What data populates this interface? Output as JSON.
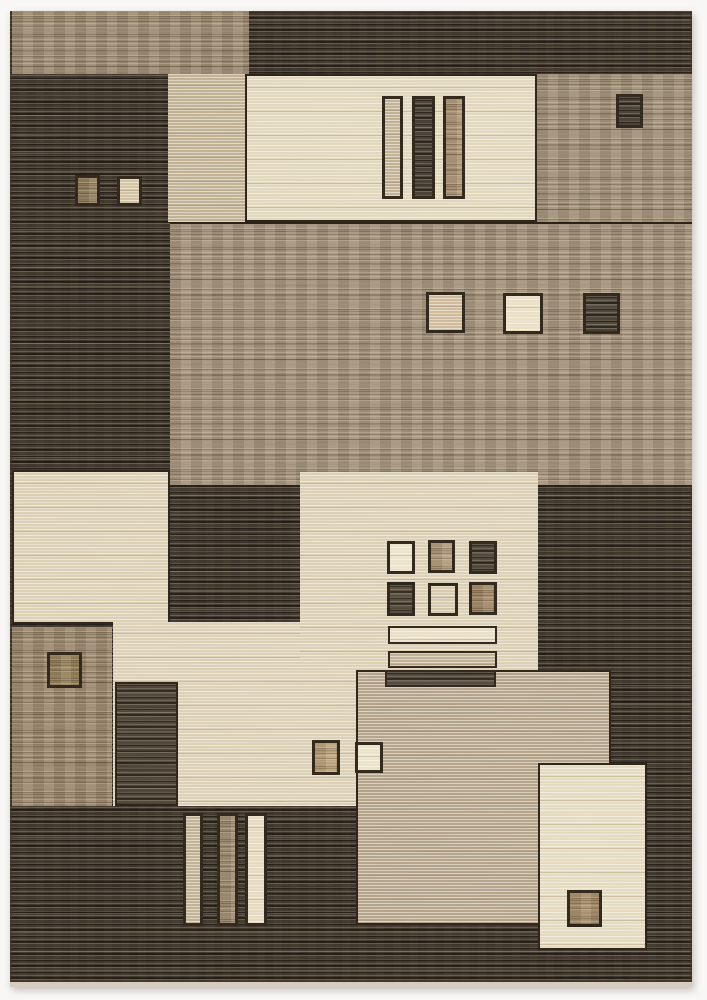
{
  "image": {
    "type": "product-photo",
    "subject": "modern geometric area rug, brown beige cream patchwork of rectangles and small squares with striated weave",
    "background_color": "#f8f7f5",
    "fringe_edge_color": "#d5cec0"
  },
  "palette": {
    "rug_base_dark": "#29231d",
    "tan_band": "#877560",
    "taupe": "#8d7b65",
    "cream": "#d9cdb0",
    "beige": "#d2c5a8",
    "brown": "#84715a",
    "near_black": "#2e2922"
  },
  "rug": {
    "left": 10,
    "top": 11,
    "width": 682,
    "height": 976,
    "base_color": "#29231d",
    "blocks": [
      {
        "name": "top-tan-band",
        "x": 2,
        "y": 0,
        "w": 237,
        "h": 63,
        "color": "#877560",
        "texture": "mid",
        "frame": "none"
      },
      {
        "name": "top-tan-column",
        "x": 158,
        "y": 63,
        "w": 77,
        "h": 148,
        "color": "#b19f82",
        "texture": "light",
        "frame": "none"
      },
      {
        "name": "top-cream-panel",
        "x": 235,
        "y": 63,
        "w": 292,
        "h": 148,
        "color": "#d9cdb0",
        "texture": "light",
        "frame": "panel"
      },
      {
        "name": "top-bar-tan",
        "x": 372,
        "y": 85,
        "w": 21,
        "h": 103,
        "color": "#b1a083",
        "texture": "light",
        "frame": "sq"
      },
      {
        "name": "top-bar-dark",
        "x": 402,
        "y": 85,
        "w": 23,
        "h": 103,
        "color": "#2e2922",
        "texture": "dark",
        "frame": "sq"
      },
      {
        "name": "top-bar-brown",
        "x": 433,
        "y": 85,
        "w": 22,
        "h": 103,
        "color": "#9a8265",
        "texture": "mid",
        "frame": "sq"
      },
      {
        "name": "top-taupe-panel",
        "x": 527,
        "y": 63,
        "w": 155,
        "h": 148,
        "color": "#8d7b65",
        "texture": "mid",
        "frame": "none"
      },
      {
        "name": "top-small-dark-square",
        "x": 606,
        "y": 83,
        "w": 27,
        "h": 34,
        "color": "#2d2821",
        "texture": "dark",
        "frame": "sq"
      },
      {
        "name": "left-square-brown",
        "x": 65,
        "y": 164,
        "w": 25,
        "h": 31,
        "color": "#7b6748",
        "texture": "mid",
        "frame": "sq"
      },
      {
        "name": "left-square-beige",
        "x": 107,
        "y": 165,
        "w": 25,
        "h": 30,
        "color": "#c7b694",
        "texture": "light",
        "frame": "sq"
      },
      {
        "name": "middle-field",
        "x": 160,
        "y": 211,
        "w": 522,
        "h": 263,
        "color": "#8f7d68",
        "texture": "mid",
        "frame": "top"
      },
      {
        "name": "mid-square-tan",
        "x": 416,
        "y": 281,
        "w": 39,
        "h": 41,
        "color": "#c2ab89",
        "texture": "light",
        "frame": "sq"
      },
      {
        "name": "mid-square-cream",
        "x": 493,
        "y": 282,
        "w": 40,
        "h": 41,
        "color": "#e4d8ba",
        "texture": "light",
        "frame": "sq"
      },
      {
        "name": "mid-square-dark",
        "x": 573,
        "y": 282,
        "w": 37,
        "h": 41,
        "color": "#322d26",
        "texture": "dark",
        "frame": "sq"
      },
      {
        "name": "left-cream-panel",
        "x": 2,
        "y": 459,
        "w": 158,
        "h": 154,
        "color": "#d2c5a7",
        "texture": "light",
        "frame": "panel"
      },
      {
        "name": "left-brown-block",
        "x": 2,
        "y": 616,
        "w": 100,
        "h": 179,
        "color": "#84715a",
        "texture": "mid",
        "frame": "none"
      },
      {
        "name": "brown-block-square",
        "x": 37,
        "y": 641,
        "w": 35,
        "h": 36,
        "color": "#7e6a47",
        "texture": "mid",
        "frame": "sq"
      },
      {
        "name": "beige-field-lower",
        "x": 103,
        "y": 611,
        "w": 245,
        "h": 184,
        "color": "#d2c5a8",
        "texture": "light",
        "frame": "none"
      },
      {
        "name": "beige-dark-patch",
        "x": 105,
        "y": 671,
        "w": 63,
        "h": 124,
        "color": "#332d25",
        "texture": "dark",
        "frame": "panel"
      },
      {
        "name": "beige-field-main",
        "x": 290,
        "y": 461,
        "w": 238,
        "h": 198,
        "color": "#d2c5a8",
        "texture": "light",
        "frame": "none"
      },
      {
        "name": "center-taupe-panel",
        "x": 346,
        "y": 659,
        "w": 255,
        "h": 255,
        "color": "#a28f78",
        "texture": "light",
        "frame": "panel"
      },
      {
        "name": "grid-square-cream",
        "x": 377,
        "y": 530,
        "w": 28,
        "h": 33,
        "color": "#e7dcc0",
        "texture": "light",
        "frame": "sq"
      },
      {
        "name": "grid-square-tan",
        "x": 418,
        "y": 529,
        "w": 27,
        "h": 33,
        "color": "#a0876a",
        "texture": "mid",
        "frame": "sq"
      },
      {
        "name": "grid-square-dark",
        "x": 459,
        "y": 530,
        "w": 28,
        "h": 33,
        "color": "#332e27",
        "texture": "dark",
        "frame": "sq"
      },
      {
        "name": "grid-square-dark2",
        "x": 377,
        "y": 571,
        "w": 28,
        "h": 34,
        "color": "#3b352b",
        "texture": "dark",
        "frame": "sq"
      },
      {
        "name": "grid-square-beige",
        "x": 418,
        "y": 572,
        "w": 30,
        "h": 33,
        "color": "#cbbea0",
        "texture": "light",
        "frame": "sq"
      },
      {
        "name": "grid-square-brown",
        "x": 459,
        "y": 571,
        "w": 28,
        "h": 33,
        "color": "#8a7152",
        "texture": "mid",
        "frame": "sq"
      },
      {
        "name": "center-bar-cream",
        "x": 378,
        "y": 615,
        "w": 109,
        "h": 18,
        "color": "#e3d8bc",
        "texture": "light",
        "frame": "hbar"
      },
      {
        "name": "center-bar-tan",
        "x": 378,
        "y": 640,
        "w": 109,
        "h": 17,
        "color": "#b1a084",
        "texture": "light",
        "frame": "hbar"
      },
      {
        "name": "center-bar-dark",
        "x": 375,
        "y": 659,
        "w": 111,
        "h": 17,
        "color": "#363028",
        "texture": "dark",
        "frame": "hbar"
      },
      {
        "name": "pair-square-tan",
        "x": 302,
        "y": 729,
        "w": 28,
        "h": 35,
        "color": "#ab9068",
        "texture": "mid",
        "frame": "sq"
      },
      {
        "name": "pair-square-cream",
        "x": 345,
        "y": 731,
        "w": 28,
        "h": 31,
        "color": "#e6dbc0",
        "texture": "light",
        "frame": "sq"
      },
      {
        "name": "bottom-bar-tan",
        "x": 173,
        "y": 802,
        "w": 20,
        "h": 113,
        "color": "#b2a184",
        "texture": "light",
        "frame": "sq"
      },
      {
        "name": "bottom-bar-brown",
        "x": 207,
        "y": 802,
        "w": 21,
        "h": 113,
        "color": "#8c7860",
        "texture": "mid",
        "frame": "sq"
      },
      {
        "name": "bottom-bar-cream",
        "x": 235,
        "y": 802,
        "w": 22,
        "h": 113,
        "color": "#dcd1b5",
        "texture": "light",
        "frame": "sq"
      },
      {
        "name": "bottom-cream-panel",
        "x": 528,
        "y": 752,
        "w": 109,
        "h": 187,
        "color": "#dcd1b4",
        "texture": "light",
        "frame": "panel"
      },
      {
        "name": "bottom-brown-square",
        "x": 557,
        "y": 879,
        "w": 35,
        "h": 37,
        "color": "#907857",
        "texture": "mid",
        "frame": "sq"
      }
    ]
  }
}
